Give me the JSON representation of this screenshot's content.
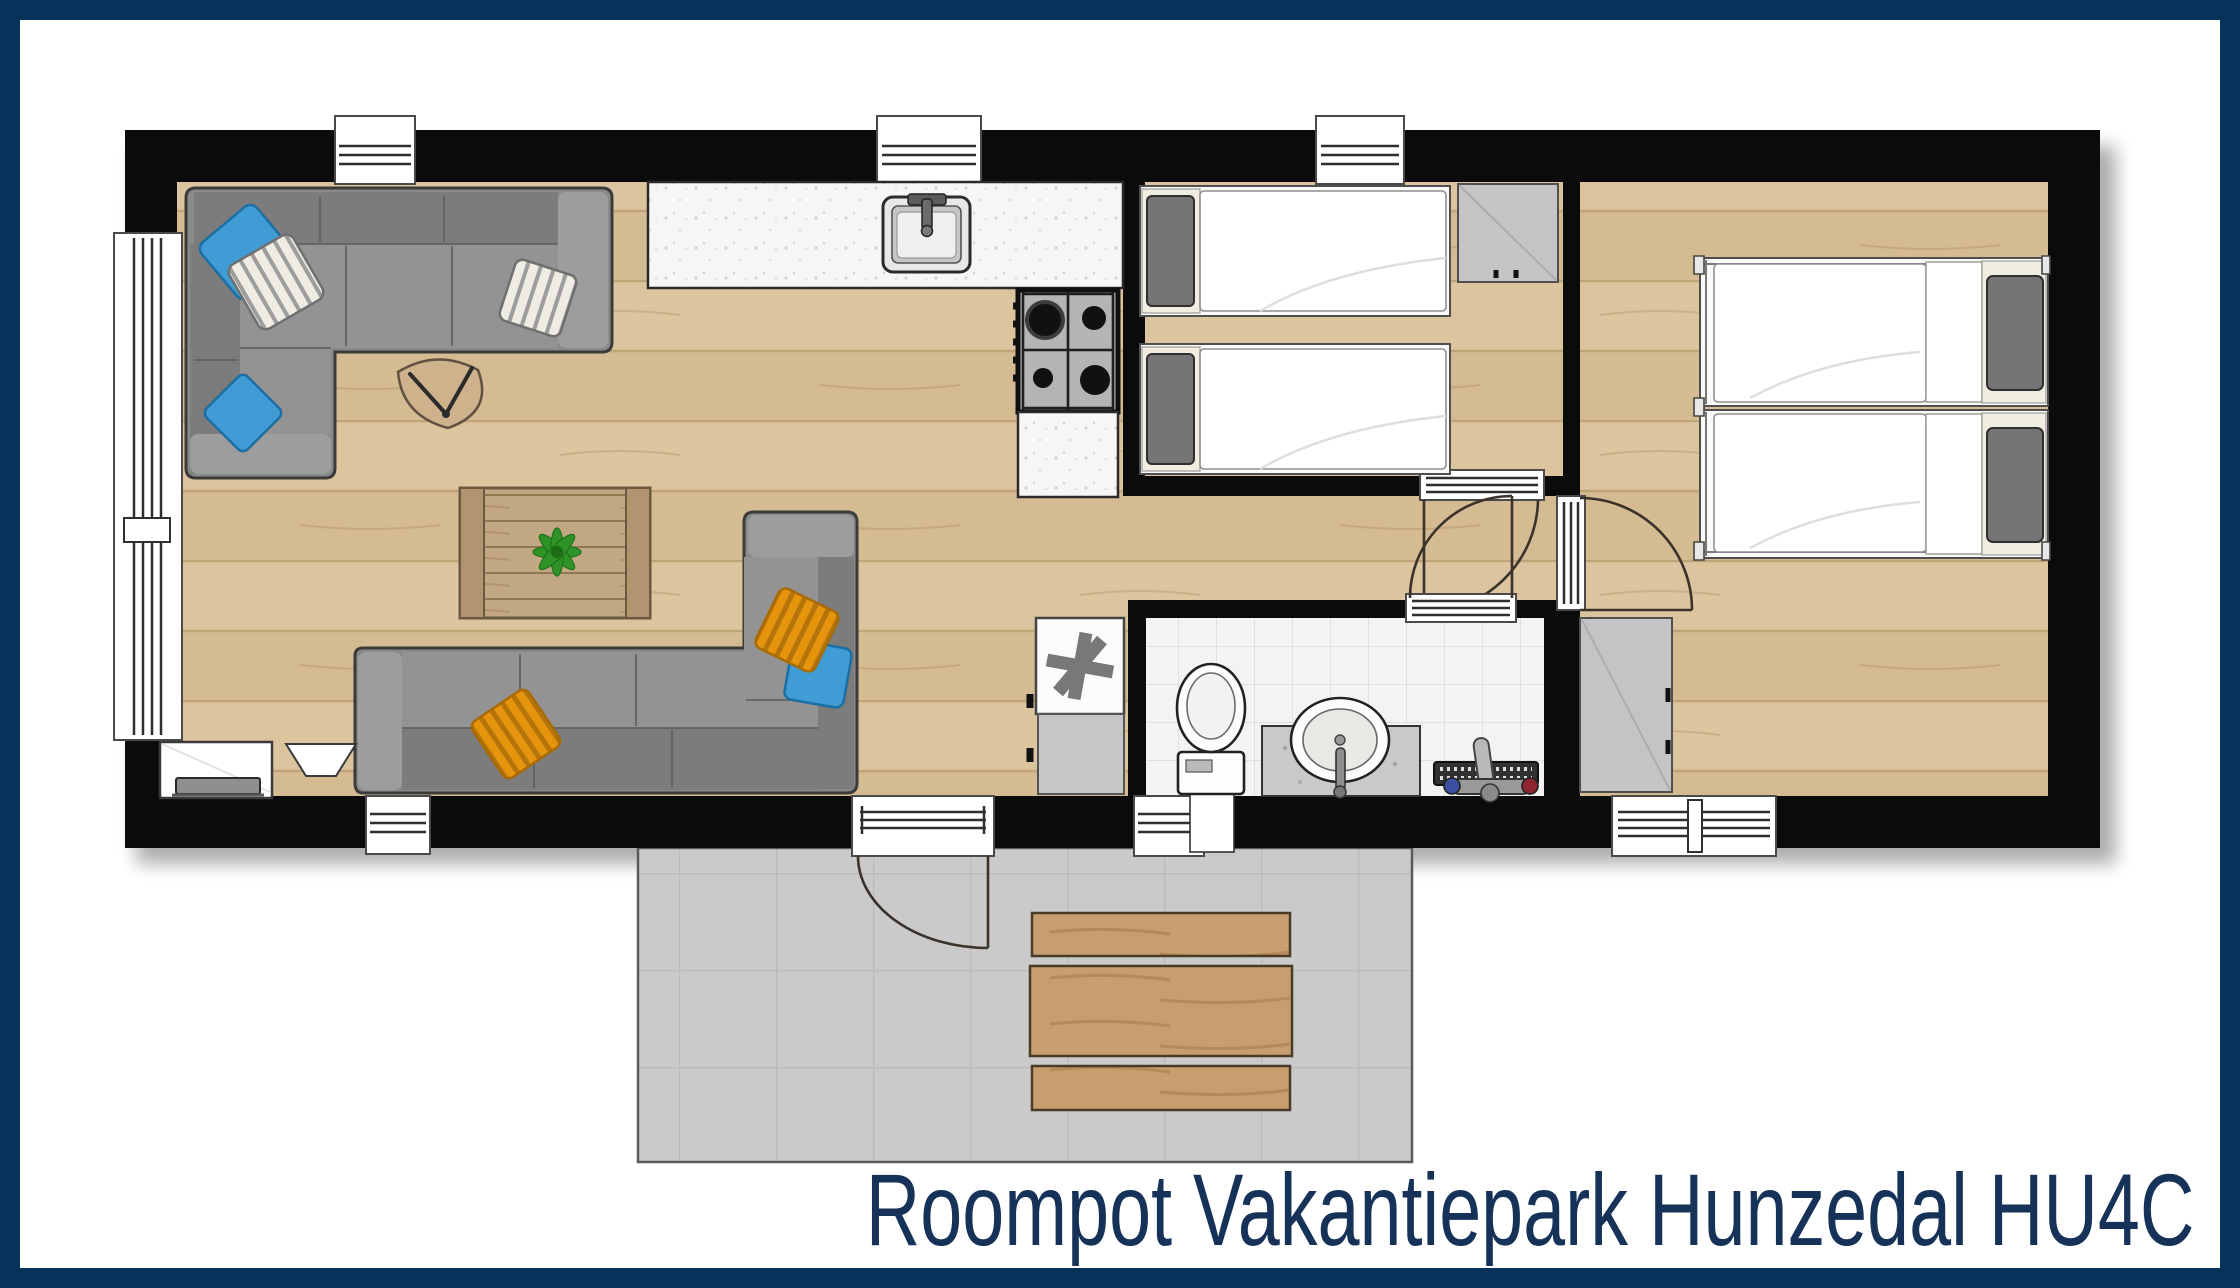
{
  "title": "Roompot Vakantiepark Hunzedal HU4C",
  "colors": {
    "frame": "#07325A",
    "title-text": "#163259",
    "wall": "#0B0B0B",
    "wood": "#DCC49F",
    "tile": "#F3F3F3",
    "terrace": "#CACACA",
    "sofa": "#8A8A8A",
    "pillow-blue": "#3F9CD4",
    "pillow-orange": "#E6940E"
  },
  "rooms": [
    "living-room",
    "kitchen",
    "small-bedroom",
    "large-bedroom",
    "bathroom",
    "hallway",
    "terrace"
  ]
}
